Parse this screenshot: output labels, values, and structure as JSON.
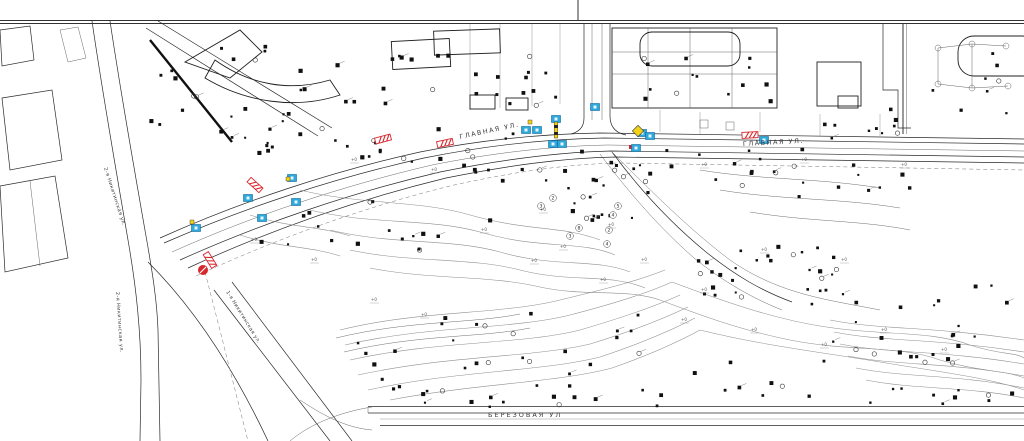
{
  "map": {
    "colors": {
      "red": "#d7262c",
      "blue": "#2fa8dc",
      "blue_dark": "#12699c",
      "yellow": "#f2d117",
      "ink": "#1a1a1a",
      "label": "#3c3c3c"
    },
    "street_labels": [
      {
        "text": "ГЛАВНАЯ УЛ.",
        "x": 460,
        "y": 139,
        "rot": -12,
        "size": 6.5,
        "ls": 1.5
      },
      {
        "text": "ГЛАВНАЯ УЛ.",
        "x": 743,
        "y": 146,
        "rot": -3,
        "size": 6.5,
        "ls": 1.5
      },
      {
        "text": "БЕРЕЗОВАЯ УЛ",
        "x": 488,
        "y": 417,
        "rot": 0,
        "size": 6.5,
        "ls": 2
      },
      {
        "text": "2-я Никитинская ул.",
        "x": 104,
        "y": 168,
        "rot": 72,
        "size": 5,
        "ls": 0.4
      },
      {
        "text": "2-я Никитинская ул.",
        "x": 116,
        "y": 292,
        "rot": 86,
        "size": 5,
        "ls": 0.4
      },
      {
        "text": "1-я Никитинская ул.",
        "x": 226,
        "y": 292,
        "rot": 58,
        "size": 5,
        "ls": 0.4
      }
    ],
    "contour_labels": [
      {
        "v": "2",
        "x": 553,
        "y": 198
      },
      {
        "v": "3",
        "x": 541,
        "y": 206
      },
      {
        "v": "5",
        "x": 618,
        "y": 206
      },
      {
        "v": "4",
        "x": 613,
        "y": 215
      },
      {
        "v": "8",
        "x": 579,
        "y": 228
      },
      {
        "v": "2",
        "x": 609,
        "y": 230
      },
      {
        "v": "3",
        "x": 570,
        "y": 236
      },
      {
        "v": "4",
        "x": 607,
        "y": 244
      }
    ],
    "micro_labels": [
      {
        "t": "+0",
        "x": 608,
        "y": 226
      },
      {
        "t": "+0",
        "x": 560,
        "y": 248
      },
      {
        "t": "+0",
        "x": 531,
        "y": 262
      },
      {
        "t": "+0",
        "x": 600,
        "y": 281
      },
      {
        "t": "+0",
        "x": 371,
        "y": 301
      },
      {
        "t": "+0",
        "x": 421,
        "y": 316
      },
      {
        "t": "+0",
        "x": 681,
        "y": 321
      },
      {
        "t": "+0",
        "x": 751,
        "y": 331
      },
      {
        "t": "+0",
        "x": 821,
        "y": 346
      },
      {
        "t": "+0",
        "x": 481,
        "y": 231
      },
      {
        "t": "+0",
        "x": 540,
        "y": 211
      },
      {
        "t": "+0",
        "x": 641,
        "y": 261
      },
      {
        "t": "+0",
        "x": 701,
        "y": 291
      },
      {
        "t": "+0",
        "x": 761,
        "y": 251
      },
      {
        "t": "+0",
        "x": 841,
        "y": 261
      },
      {
        "t": "+0",
        "x": 881,
        "y": 331
      },
      {
        "t": "+0",
        "x": 941,
        "y": 351
      },
      {
        "t": "+0",
        "x": 351,
        "y": 161
      },
      {
        "t": "+0",
        "x": 431,
        "y": 171
      },
      {
        "t": "+0",
        "x": 701,
        "y": 166
      },
      {
        "t": "+0",
        "x": 801,
        "y": 161
      },
      {
        "t": "+0",
        "x": 901,
        "y": 166
      },
      {
        "t": "+0",
        "x": 251,
        "y": 241
      },
      {
        "t": "+0",
        "x": 311,
        "y": 261
      }
    ],
    "markers": {
      "red_bars": [
        {
          "x": 383,
          "y": 139,
          "rot": -15
        },
        {
          "x": 445,
          "y": 143,
          "rot": -12
        },
        {
          "x": 750,
          "y": 135,
          "rot": -3
        },
        {
          "x": 255,
          "y": 185,
          "rot": 42
        },
        {
          "x": 210,
          "y": 260,
          "rot": 58
        }
      ],
      "red_circles": [
        {
          "x": 203,
          "y": 270
        }
      ],
      "red_dots": [
        {
          "x": 631,
          "y": 147
        }
      ],
      "blue_squares": [
        {
          "x": 196,
          "y": 228
        },
        {
          "x": 248,
          "y": 198
        },
        {
          "x": 262,
          "y": 218
        },
        {
          "x": 292,
          "y": 178
        },
        {
          "x": 296,
          "y": 202
        },
        {
          "x": 526,
          "y": 130
        },
        {
          "x": 537,
          "y": 130
        },
        {
          "x": 553,
          "y": 144
        },
        {
          "x": 562,
          "y": 144
        },
        {
          "x": 595,
          "y": 107
        },
        {
          "x": 642,
          "y": 133
        },
        {
          "x": 650,
          "y": 136
        },
        {
          "x": 636,
          "y": 148
        },
        {
          "x": 764,
          "y": 140
        },
        {
          "x": 556,
          "y": 119
        }
      ],
      "yellow_poles": [
        {
          "x": 556,
          "y": 130
        }
      ],
      "yellow_diamonds": [
        {
          "x": 638,
          "y": 131
        }
      ],
      "yellow_dots": [
        {
          "x": 288,
          "y": 179
        },
        {
          "x": 530,
          "y": 122
        },
        {
          "x": 192,
          "y": 222
        }
      ]
    },
    "tree_areas": [
      {
        "x": 150,
        "y": 42,
        "w": 205,
        "h": 95,
        "n": 26
      },
      {
        "x": 380,
        "y": 55,
        "w": 190,
        "h": 60,
        "n": 22
      },
      {
        "x": 210,
        "y": 128,
        "w": 330,
        "h": 45,
        "n": 30
      },
      {
        "x": 560,
        "y": 150,
        "w": 200,
        "h": 40,
        "n": 18
      },
      {
        "x": 240,
        "y": 185,
        "w": 200,
        "h": 70,
        "n": 16
      },
      {
        "x": 470,
        "y": 168,
        "w": 180,
        "h": 60,
        "n": 20
      },
      {
        "x": 678,
        "y": 243,
        "w": 165,
        "h": 62,
        "n": 30
      },
      {
        "x": 740,
        "y": 148,
        "w": 170,
        "h": 50,
        "n": 16
      },
      {
        "x": 818,
        "y": 108,
        "w": 82,
        "h": 36,
        "n": 10
      },
      {
        "x": 340,
        "y": 312,
        "w": 300,
        "h": 86,
        "n": 32
      },
      {
        "x": 380,
        "y": 390,
        "w": 290,
        "h": 18,
        "n": 12
      },
      {
        "x": 818,
        "y": 282,
        "w": 195,
        "h": 82,
        "n": 26
      },
      {
        "x": 858,
        "y": 388,
        "w": 160,
        "h": 18,
        "n": 10
      },
      {
        "x": 640,
        "y": 52,
        "w": 150,
        "h": 52,
        "n": 14
      },
      {
        "x": 905,
        "y": 52,
        "w": 112,
        "h": 62,
        "n": 8
      },
      {
        "x": 690,
        "y": 360,
        "w": 130,
        "h": 40,
        "n": 8
      }
    ]
  }
}
